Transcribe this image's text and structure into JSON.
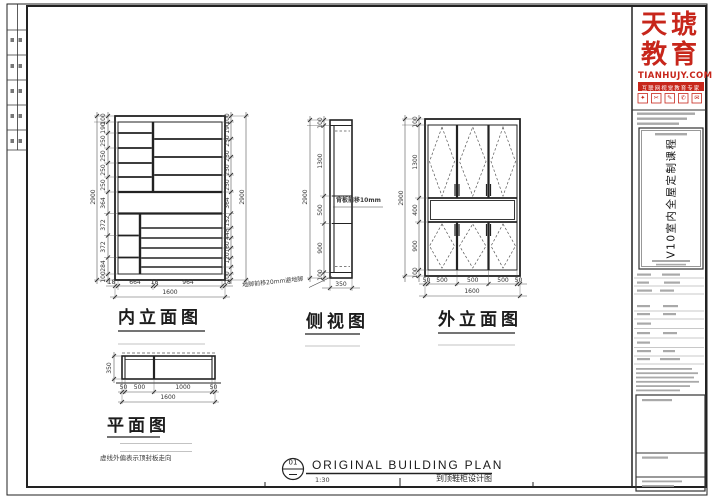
{
  "sheet": {
    "line_color": "#2a2a2a",
    "accent_red": "#c7261b"
  },
  "logo": {
    "brand_line1": "天琥",
    "brand_line2": "教育",
    "website": "TIANHUJY.COM",
    "tagline": "互联网视觉教育专家",
    "icons": [
      "✦",
      "✂",
      "✎",
      "✆",
      "✉"
    ]
  },
  "title_block": {
    "course_title": "V10室内全屋定制课程"
  },
  "views": {
    "inner": {
      "label": "内立面图",
      "overall_height": "2900",
      "overall_height_right": "2900",
      "overall_width": "1600",
      "dims_left": [
        "100",
        "190",
        "250",
        "250",
        "250",
        "250",
        "364",
        "372",
        "372",
        "284",
        "100"
      ],
      "dims_right": [
        "100",
        "190",
        "250",
        "250",
        "250",
        "250",
        "364",
        "152",
        "448",
        "160",
        "120",
        "100"
      ],
      "dims_bottom": [
        "18",
        "664",
        "18",
        "964",
        "18"
      ]
    },
    "side": {
      "label": "侧视图",
      "overall_height": "2900",
      "width": "350",
      "dims": [
        "100",
        "1300",
        "500",
        "900",
        "100"
      ],
      "note_back_panel": "背板前移10mm",
      "note_foot": "地脚前移20mm避地脚"
    },
    "outer": {
      "label": "外立面图",
      "overall_height": "2900",
      "overall_width": "1600",
      "dims_left": [
        "100",
        "1300",
        "400",
        "900",
        "100"
      ],
      "dims_bottom": [
        "50",
        "500",
        "500",
        "500",
        "50"
      ]
    },
    "plan": {
      "label": "平面图",
      "depth": "350",
      "overall_width": "1600",
      "dims_bottom": [
        "50",
        "500",
        "1000",
        "50"
      ],
      "note": "虚线外偏表示顶封板走向"
    }
  },
  "title_bar": {
    "detail_number": "01",
    "title": "ORIGINAL BUILDING PLAN",
    "scale": "1:30",
    "drawing_name": "到顶鞋柜设计图"
  }
}
